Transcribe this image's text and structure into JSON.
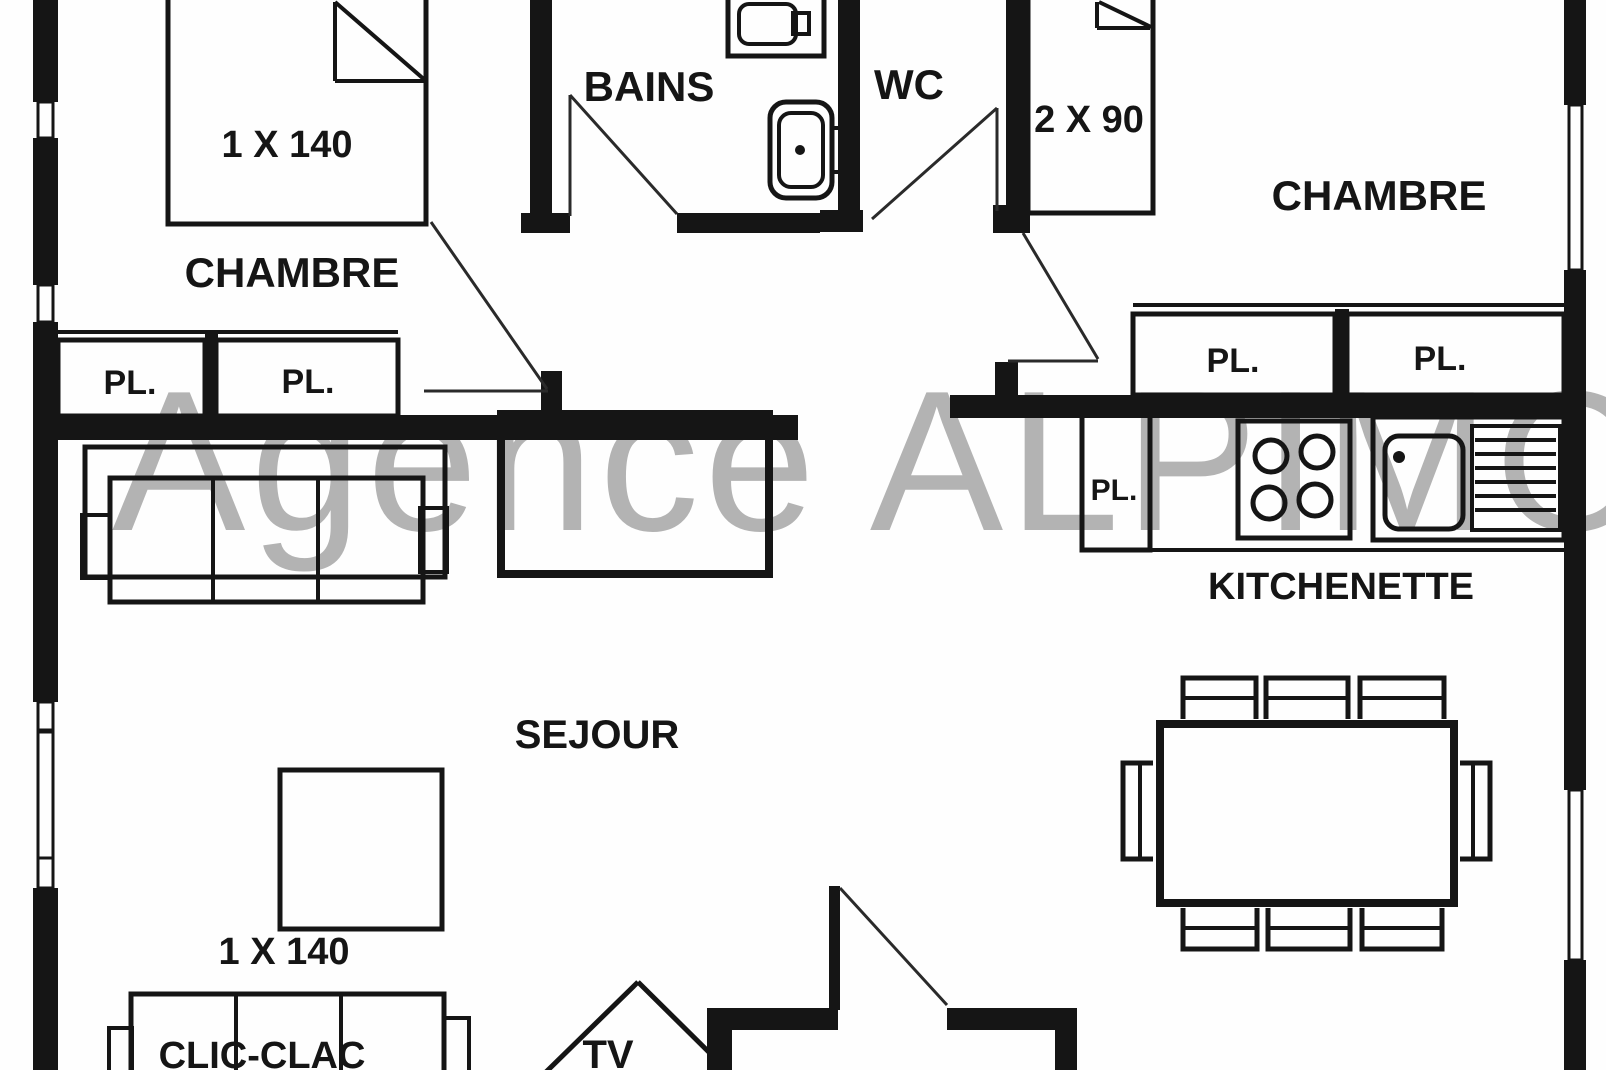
{
  "watermark": {
    "text": "Agence ALPIMO",
    "color": "#b3b3b3"
  },
  "colors": {
    "ink": "#151515",
    "background": "#ffffff"
  },
  "rooms": {
    "chambre_left": {
      "label": "CHAMBRE"
    },
    "bains": {
      "label": "BAINS"
    },
    "wc": {
      "label": "WC"
    },
    "chambre_right": {
      "label": "CHAMBRE"
    },
    "sejour": {
      "label": "SEJOUR"
    },
    "kitchenette": {
      "label": "KITCHENETTE"
    }
  },
  "furniture": {
    "bed_double_left": {
      "label": "1 X 140"
    },
    "bed_twin_right": {
      "label": "2 X 90"
    },
    "sofa_bed": {
      "label": "CLIC-CLAC",
      "size_label": "1 X 140"
    },
    "tv": {
      "label": "TV"
    }
  },
  "closets": {
    "left_1": {
      "label": "PL."
    },
    "left_2": {
      "label": "PL."
    },
    "right_1": {
      "label": "PL."
    },
    "right_2": {
      "label": "PL."
    },
    "kitchen": {
      "label": "PL."
    }
  }
}
